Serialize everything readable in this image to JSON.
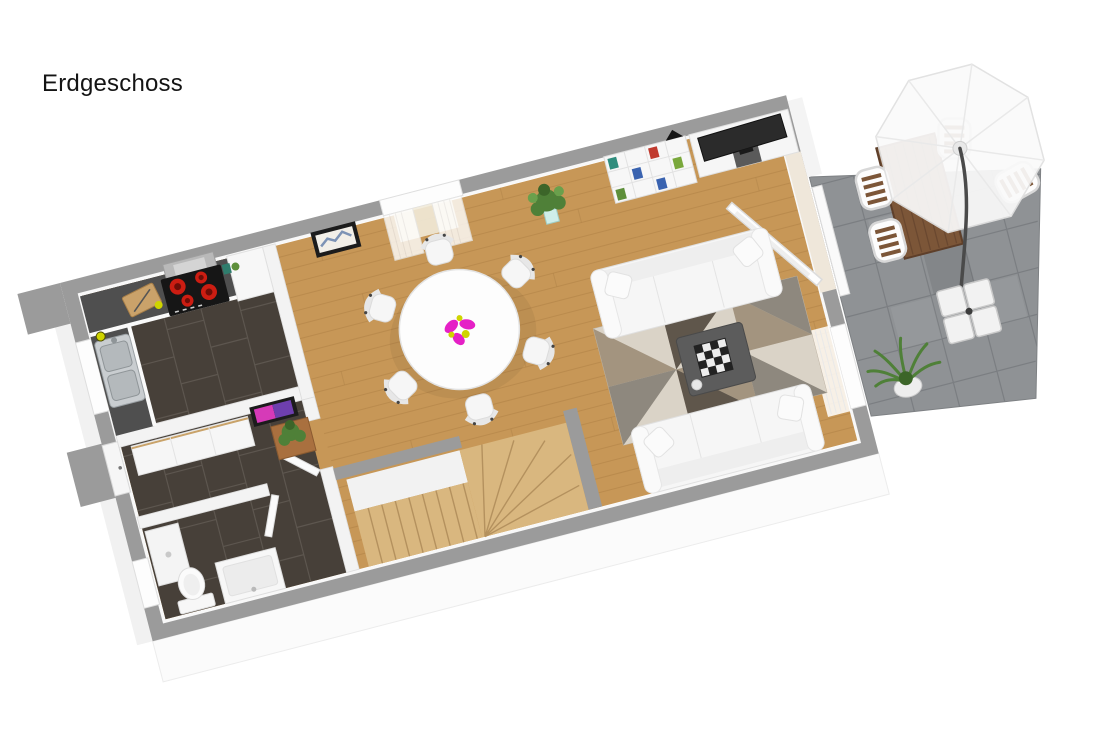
{
  "title": "Erdgeschoss",
  "colors": {
    "wall": "#9b9b9b",
    "wall_inner": "#f3f3f3",
    "outer_face": "#fbfbfb",
    "wood": "#c79757",
    "dark_tile": "#474039",
    "stone": "#8f9295",
    "counter": "#4f4f4f",
    "stove": "#161616",
    "burner": "#cc1d12",
    "steel": "#c9cdd0",
    "white_furniture": "#f6f6f6",
    "rug_base": "#cec5b8",
    "rug_light": "#dad3c7",
    "rug_mid": "#a3947f",
    "rug_gray": "#8e887e",
    "rug_dark": "#5f564b",
    "stair_wood": "#d9b77f",
    "terrace_wood": "#7c5638",
    "plant_green": "#4f8038",
    "accent_magenta": "#e520c6",
    "accent_yellow": "#cfd400",
    "art_magenta": "#d63ab8",
    "art_purple": "#6e3fae",
    "frame_black": "#1c1c1c",
    "coffee_table": "#5c5c5c"
  },
  "scene": {
    "floor_label": "Erdgeschoss",
    "objects": [
      "kitchen counter with stove and sink",
      "hall wardrobe with pink wall art and plant",
      "bathroom with toilet and vanity",
      "winder staircase",
      "round dining table with six chairs",
      "two white sofas with geometric rug and coffee table",
      "tv sideboard and cube shelf",
      "terrace with dining set, cantilever parasol and plant"
    ]
  }
}
